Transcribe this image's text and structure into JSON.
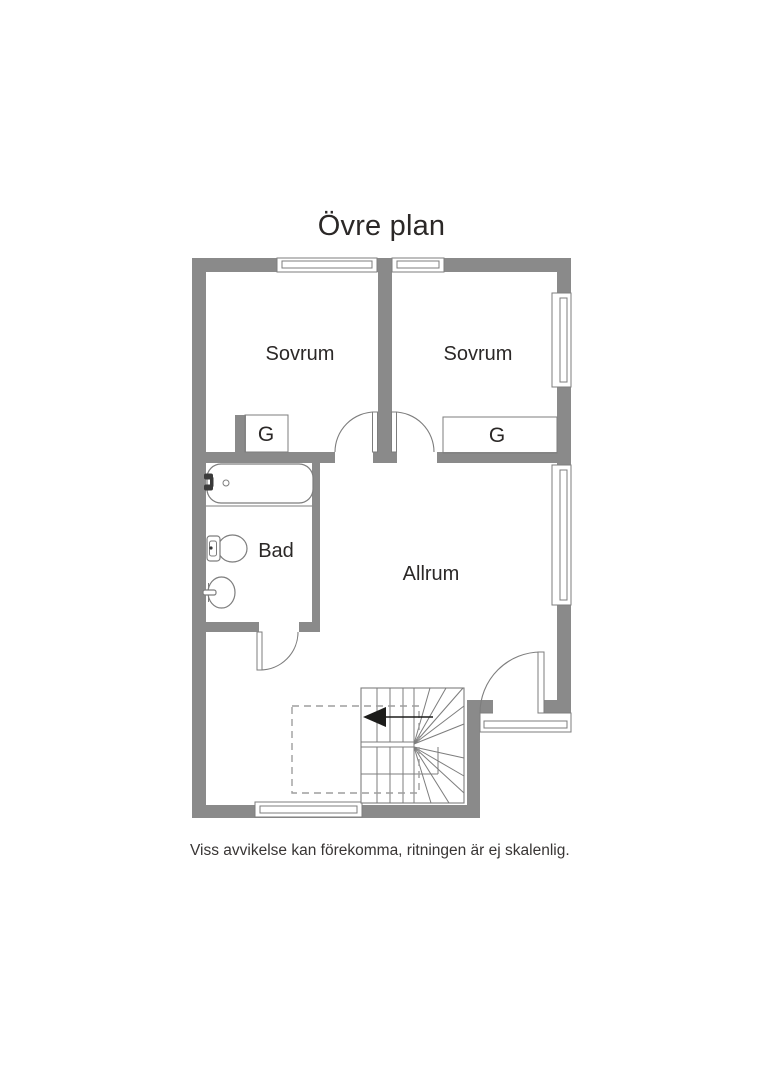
{
  "page": {
    "title": "Övre plan",
    "disclaimer": "Viss avvikelse kan förekomma, ritningen är ej skalenlig."
  },
  "rooms": {
    "bedroom_left": "Sovrum",
    "bedroom_right": "Sovrum",
    "bathroom": "Bad",
    "living_room": "Allrum",
    "closet_left": "G",
    "closet_right": "G"
  },
  "colors": {
    "wall": "#8a8a8a",
    "line": "#7d7d7d",
    "text": "#2b2827",
    "arrow": "#1d1d1b",
    "dash": "#9e9e9e",
    "bg": "#ffffff"
  }
}
